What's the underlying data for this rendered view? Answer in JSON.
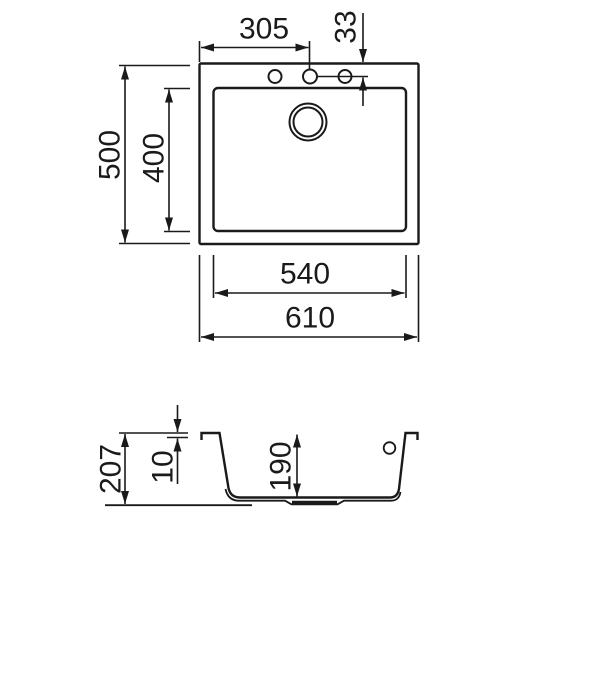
{
  "drawing": {
    "type": "sink-technical-drawing",
    "views": [
      "top-view",
      "section-view"
    ]
  },
  "dims": {
    "top_hole_distance": "305",
    "hole_edge_distance": "33",
    "overall_depth": "500",
    "bowl_inner_depth": "400",
    "bowl_inner_width": "540",
    "overall_width": "610",
    "section_total_height": "207",
    "rim_height": "10",
    "bowl_height": "190"
  },
  "colors": {
    "line": "#1a1a1a",
    "background": "#ffffff"
  }
}
